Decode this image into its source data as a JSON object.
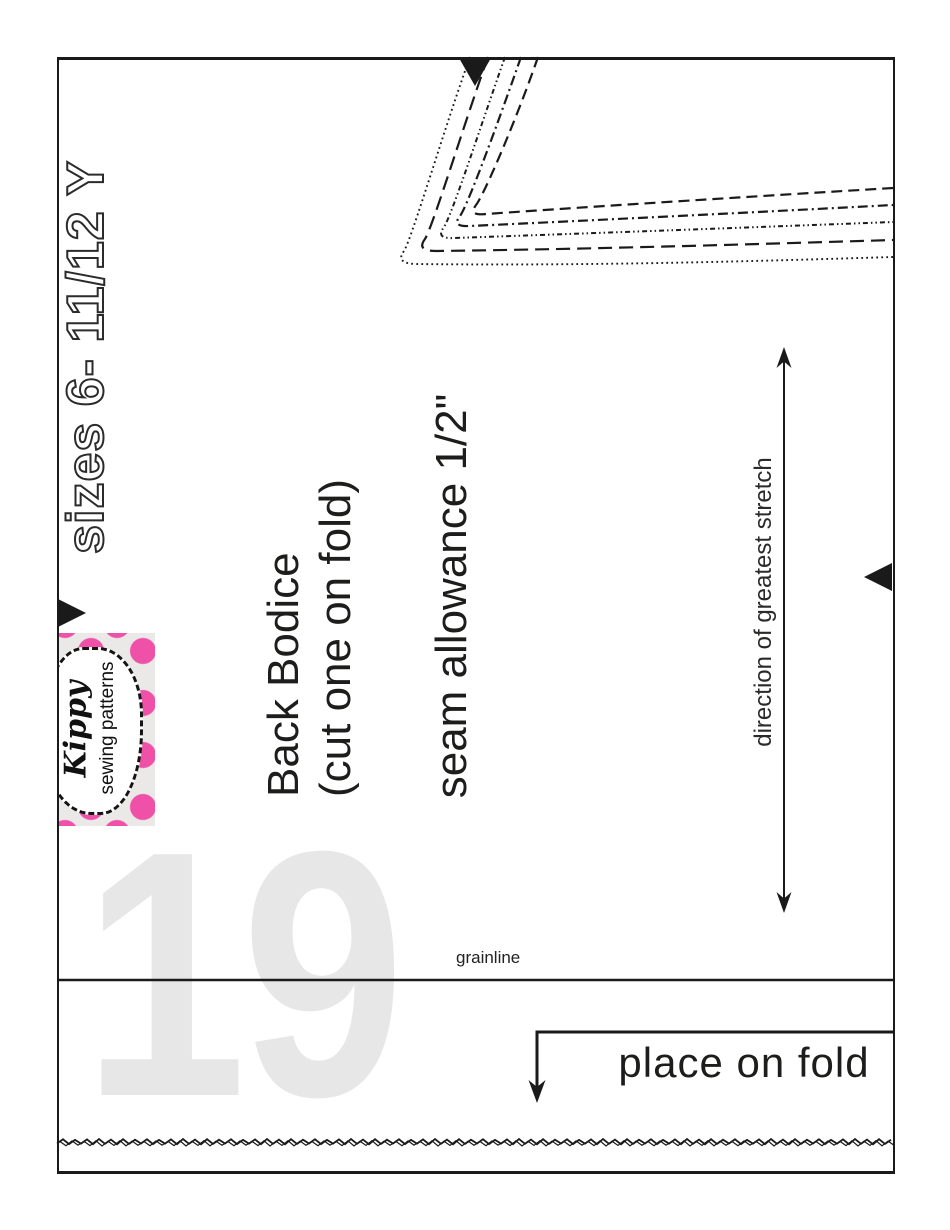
{
  "document": {
    "page_number": "19",
    "sizes_label": "sizes 6- 11/12 Y"
  },
  "logo": {
    "brand_script": "Kippy",
    "brand_subtitle": "sewing patterns",
    "dot_color": "#ef51a8",
    "background_color": "#eae9e7"
  },
  "pattern_piece": {
    "name": "Back Bodice",
    "cutting_instruction": "(cut one on fold)",
    "seam_allowance": "seam allowance 1/2\"",
    "stretch_direction_label": "direction of greatest stretch",
    "grainline_label": "grainline",
    "place_on_fold_label": "place on fold",
    "cut_line_styles": [
      "dotted",
      "long-dash",
      "dash-dot-dot",
      "dash-dot",
      "dash"
    ],
    "notch_count": 3
  },
  "colors": {
    "ink": "#1a1a1a",
    "page_number_gray": "#e7e7e7"
  }
}
